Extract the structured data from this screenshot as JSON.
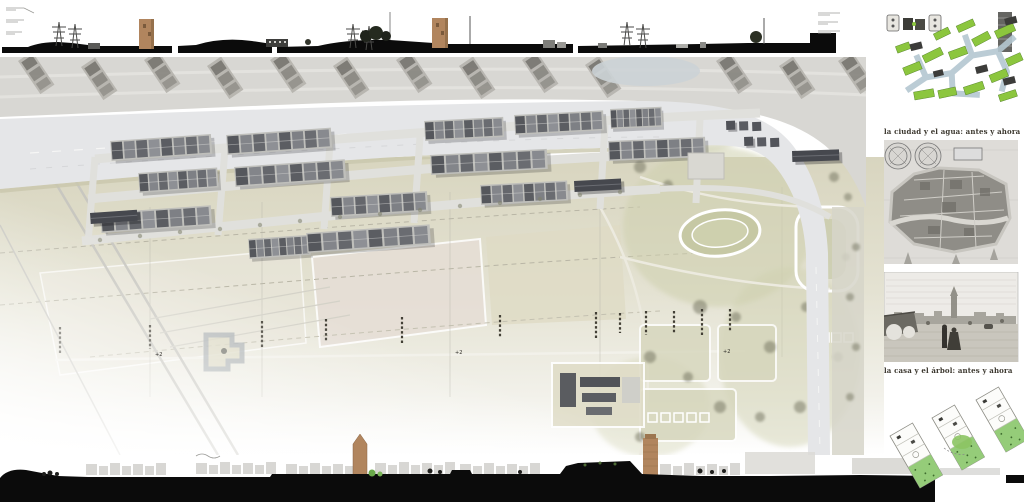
{
  "captions": {
    "city_water": "la ciudad y el agua: antes y ahora",
    "house_tree": "la casa y el árbol: antes y ahora"
  },
  "masterplan": {
    "spot_elevations": [
      {
        "label": "+2"
      },
      {
        "label": "+2"
      },
      {
        "label": "+2"
      }
    ]
  },
  "palette": {
    "section_black": "#0b0b0b",
    "brick_tower_brown": "#b1855e",
    "plan_ground_olive": "#dcd9c4",
    "plan_road_gray": "#e5e6e8",
    "park_green": "#c9cba8",
    "diagram_green": "#8cc63e",
    "canal_blue": "#b4c6d0",
    "field_pink": "#e6ded6",
    "engraving_gray": "#8f8d87"
  }
}
